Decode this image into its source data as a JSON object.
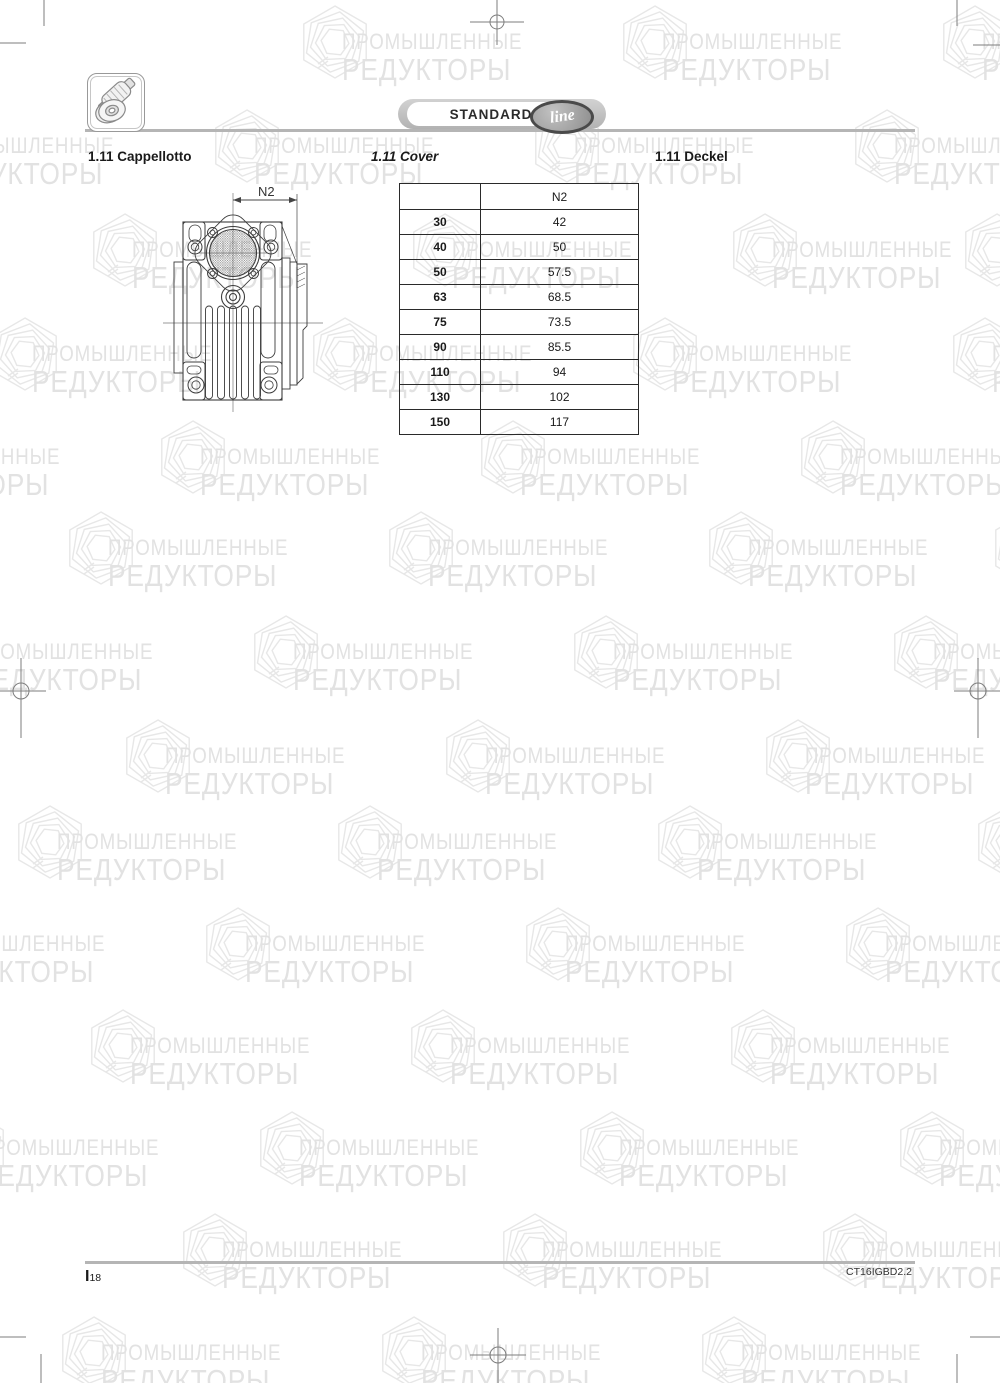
{
  "header": {
    "logo_text": "STANDARD",
    "logo_script": "line",
    "icon": "worm-gearbox-icon"
  },
  "headings": {
    "italian": "1.11 Cappellotto",
    "english": "1.11 Cover",
    "german": "1.11 Deckel"
  },
  "drawing": {
    "dimension_label": "N2"
  },
  "table": {
    "col_header": "N2",
    "rows": [
      {
        "size": "30",
        "value": "42"
      },
      {
        "size": "40",
        "value": "50"
      },
      {
        "size": "50",
        "value": "57.5"
      },
      {
        "size": "63",
        "value": "68.5"
      },
      {
        "size": "75",
        "value": "73.5"
      },
      {
        "size": "90",
        "value": "85.5"
      },
      {
        "size": "110",
        "value": "94"
      },
      {
        "size": "130",
        "value": "102"
      },
      {
        "size": "150",
        "value": "117"
      }
    ]
  },
  "footer": {
    "page_prefix": "I",
    "page_number": "18",
    "doc_code": "CT16IGBD2.2"
  },
  "watermark": {
    "line1": "ПРОМЫШЛЕННЫЕ",
    "line2": "РЕДУКТОРЫ",
    "text_color": "#e2e2e2",
    "icon_color": "#e7e7e7",
    "rows": [
      {
        "y": 2,
        "xs": [
          298,
          618,
          938
        ]
      },
      {
        "y": 106,
        "xs": [
          -110,
          210,
          530,
          850
        ]
      },
      {
        "y": 210,
        "xs": [
          88,
          408,
          728,
          960
        ]
      },
      {
        "y": 314,
        "xs": [
          -12,
          308,
          628,
          948
        ]
      },
      {
        "y": 417,
        "xs": [
          -164,
          156,
          476,
          796
        ]
      },
      {
        "y": 508,
        "xs": [
          64,
          384,
          704,
          990
        ]
      },
      {
        "y": 612,
        "xs": [
          -71,
          249,
          569,
          889
        ]
      },
      {
        "y": 716,
        "xs": [
          121,
          441,
          761
        ]
      },
      {
        "y": 802,
        "xs": [
          13,
          333,
          653,
          973
        ]
      },
      {
        "y": 904,
        "xs": [
          -119,
          201,
          521,
          841
        ]
      },
      {
        "y": 1006,
        "xs": [
          86,
          406,
          726
        ]
      },
      {
        "y": 1108,
        "xs": [
          -65,
          255,
          575,
          895
        ]
      },
      {
        "y": 1210,
        "xs": [
          178,
          498,
          818
        ]
      },
      {
        "y": 1313,
        "xs": [
          57,
          377,
          697
        ]
      }
    ]
  }
}
